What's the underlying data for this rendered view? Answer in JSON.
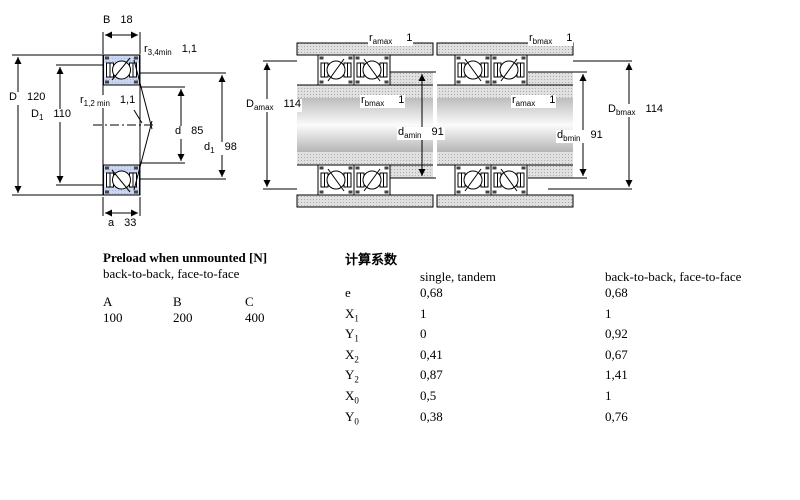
{
  "left_diagram": {
    "dims": {
      "B": {
        "sym": "B",
        "sub": "",
        "val": "18"
      },
      "r34": {
        "sym": "r",
        "sub": "3,4min",
        "val": "1,1"
      },
      "D": {
        "sym": "D",
        "sub": "",
        "val": "120"
      },
      "D1": {
        "sym": "D",
        "sub": "1",
        "val": "110"
      },
      "r12": {
        "sym": "r",
        "sub": "1,2 min",
        "val": "1,1"
      },
      "d": {
        "sym": "d",
        "sub": "",
        "val": "85"
      },
      "d1": {
        "sym": "d",
        "sub": "1",
        "val": "98"
      },
      "a": {
        "sym": "a",
        "sub": "",
        "val": "33"
      }
    }
  },
  "middle_diagram": {
    "dims": {
      "r_amax": {
        "sym": "r",
        "sub": "amax",
        "val": "1"
      },
      "D_amax": {
        "sym": "D",
        "sub": "amax",
        "val": "114"
      },
      "r_bmax": {
        "sym": "r",
        "sub": "bmax",
        "val": "1"
      },
      "d_amin": {
        "sym": "d",
        "sub": "amin",
        "val": "91"
      }
    }
  },
  "right_diagram": {
    "dims": {
      "r_bmax": {
        "sym": "r",
        "sub": "bmax",
        "val": "1"
      },
      "r_amax": {
        "sym": "r",
        "sub": "amax",
        "val": "1"
      },
      "d_bmin": {
        "sym": "d",
        "sub": "bmin",
        "val": "91"
      },
      "D_bmax": {
        "sym": "D",
        "sub": "bmax",
        "val": "114"
      }
    }
  },
  "preload_table": {
    "title": "Preload when unmounted [N]",
    "subtitle": "back-to-back, face-to-face",
    "columns": [
      "A",
      "B",
      "C"
    ],
    "values": [
      "100",
      "200",
      "400"
    ]
  },
  "factors_table": {
    "title": "计算系数",
    "col_single": "single, tandem",
    "col_pair": "back-to-back, face-to-face",
    "rows": [
      {
        "sym": "e",
        "sub": "",
        "single": "0,68",
        "pair": "0,68"
      },
      {
        "sym": "X",
        "sub": "1",
        "single": "1",
        "pair": "1"
      },
      {
        "sym": "Y",
        "sub": "1",
        "single": "0",
        "pair": "0,92"
      },
      {
        "sym": "X",
        "sub": "2",
        "single": "0,41",
        "pair": "0,67"
      },
      {
        "sym": "Y",
        "sub": "2",
        "single": "0,87",
        "pair": "1,41"
      },
      {
        "sym": "X",
        "sub": "0",
        "single": "0,5",
        "pair": "1"
      },
      {
        "sym": "Y",
        "sub": "0",
        "single": "0,38",
        "pair": "0,76"
      }
    ]
  },
  "colors": {
    "bearing_blue": "#ccd6f0",
    "housing_gray": "#dedede",
    "line": "#000000"
  }
}
